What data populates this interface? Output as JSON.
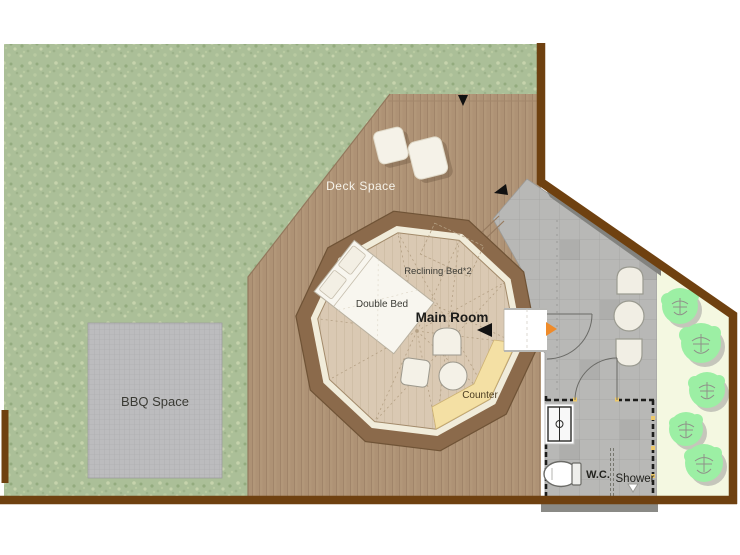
{
  "plan": {
    "type": "glamping-site-floor-plan",
    "areas": {
      "deck": {
        "label": "Deck Space"
      },
      "bbq": {
        "label": "BBQ Space"
      },
      "main_room": {
        "label": "Main Room"
      },
      "counter": {
        "label": "Counter"
      },
      "wc": {
        "label": "W.C."
      },
      "shower": {
        "label": "Shower"
      }
    },
    "furniture": {
      "double_bed": {
        "label": "Double Bed"
      },
      "reclining_bed": {
        "label": "Reclining Bed*2"
      }
    },
    "markers": {
      "entrance_arrow": "black-triangle",
      "door_swing": "quarter-arc",
      "door_direction_marker": "orange-triangle"
    },
    "colors": {
      "site_border": "#6f4110",
      "grass": "#abbf98",
      "deck_wood": "#b29779",
      "tile_gray": "#b8b8b6",
      "garden": "#f4f8e1",
      "tree_green": "#9cefa4",
      "tent_ring_brown": "#8b6a4b",
      "tent_ring_cream": "#f1ecda",
      "tent_floor": "#dac9b3",
      "counter_yellow": "#f4e0a4",
      "door_marker_orange": "#ef8b2a",
      "shadow_gray": "#82827e"
    }
  }
}
